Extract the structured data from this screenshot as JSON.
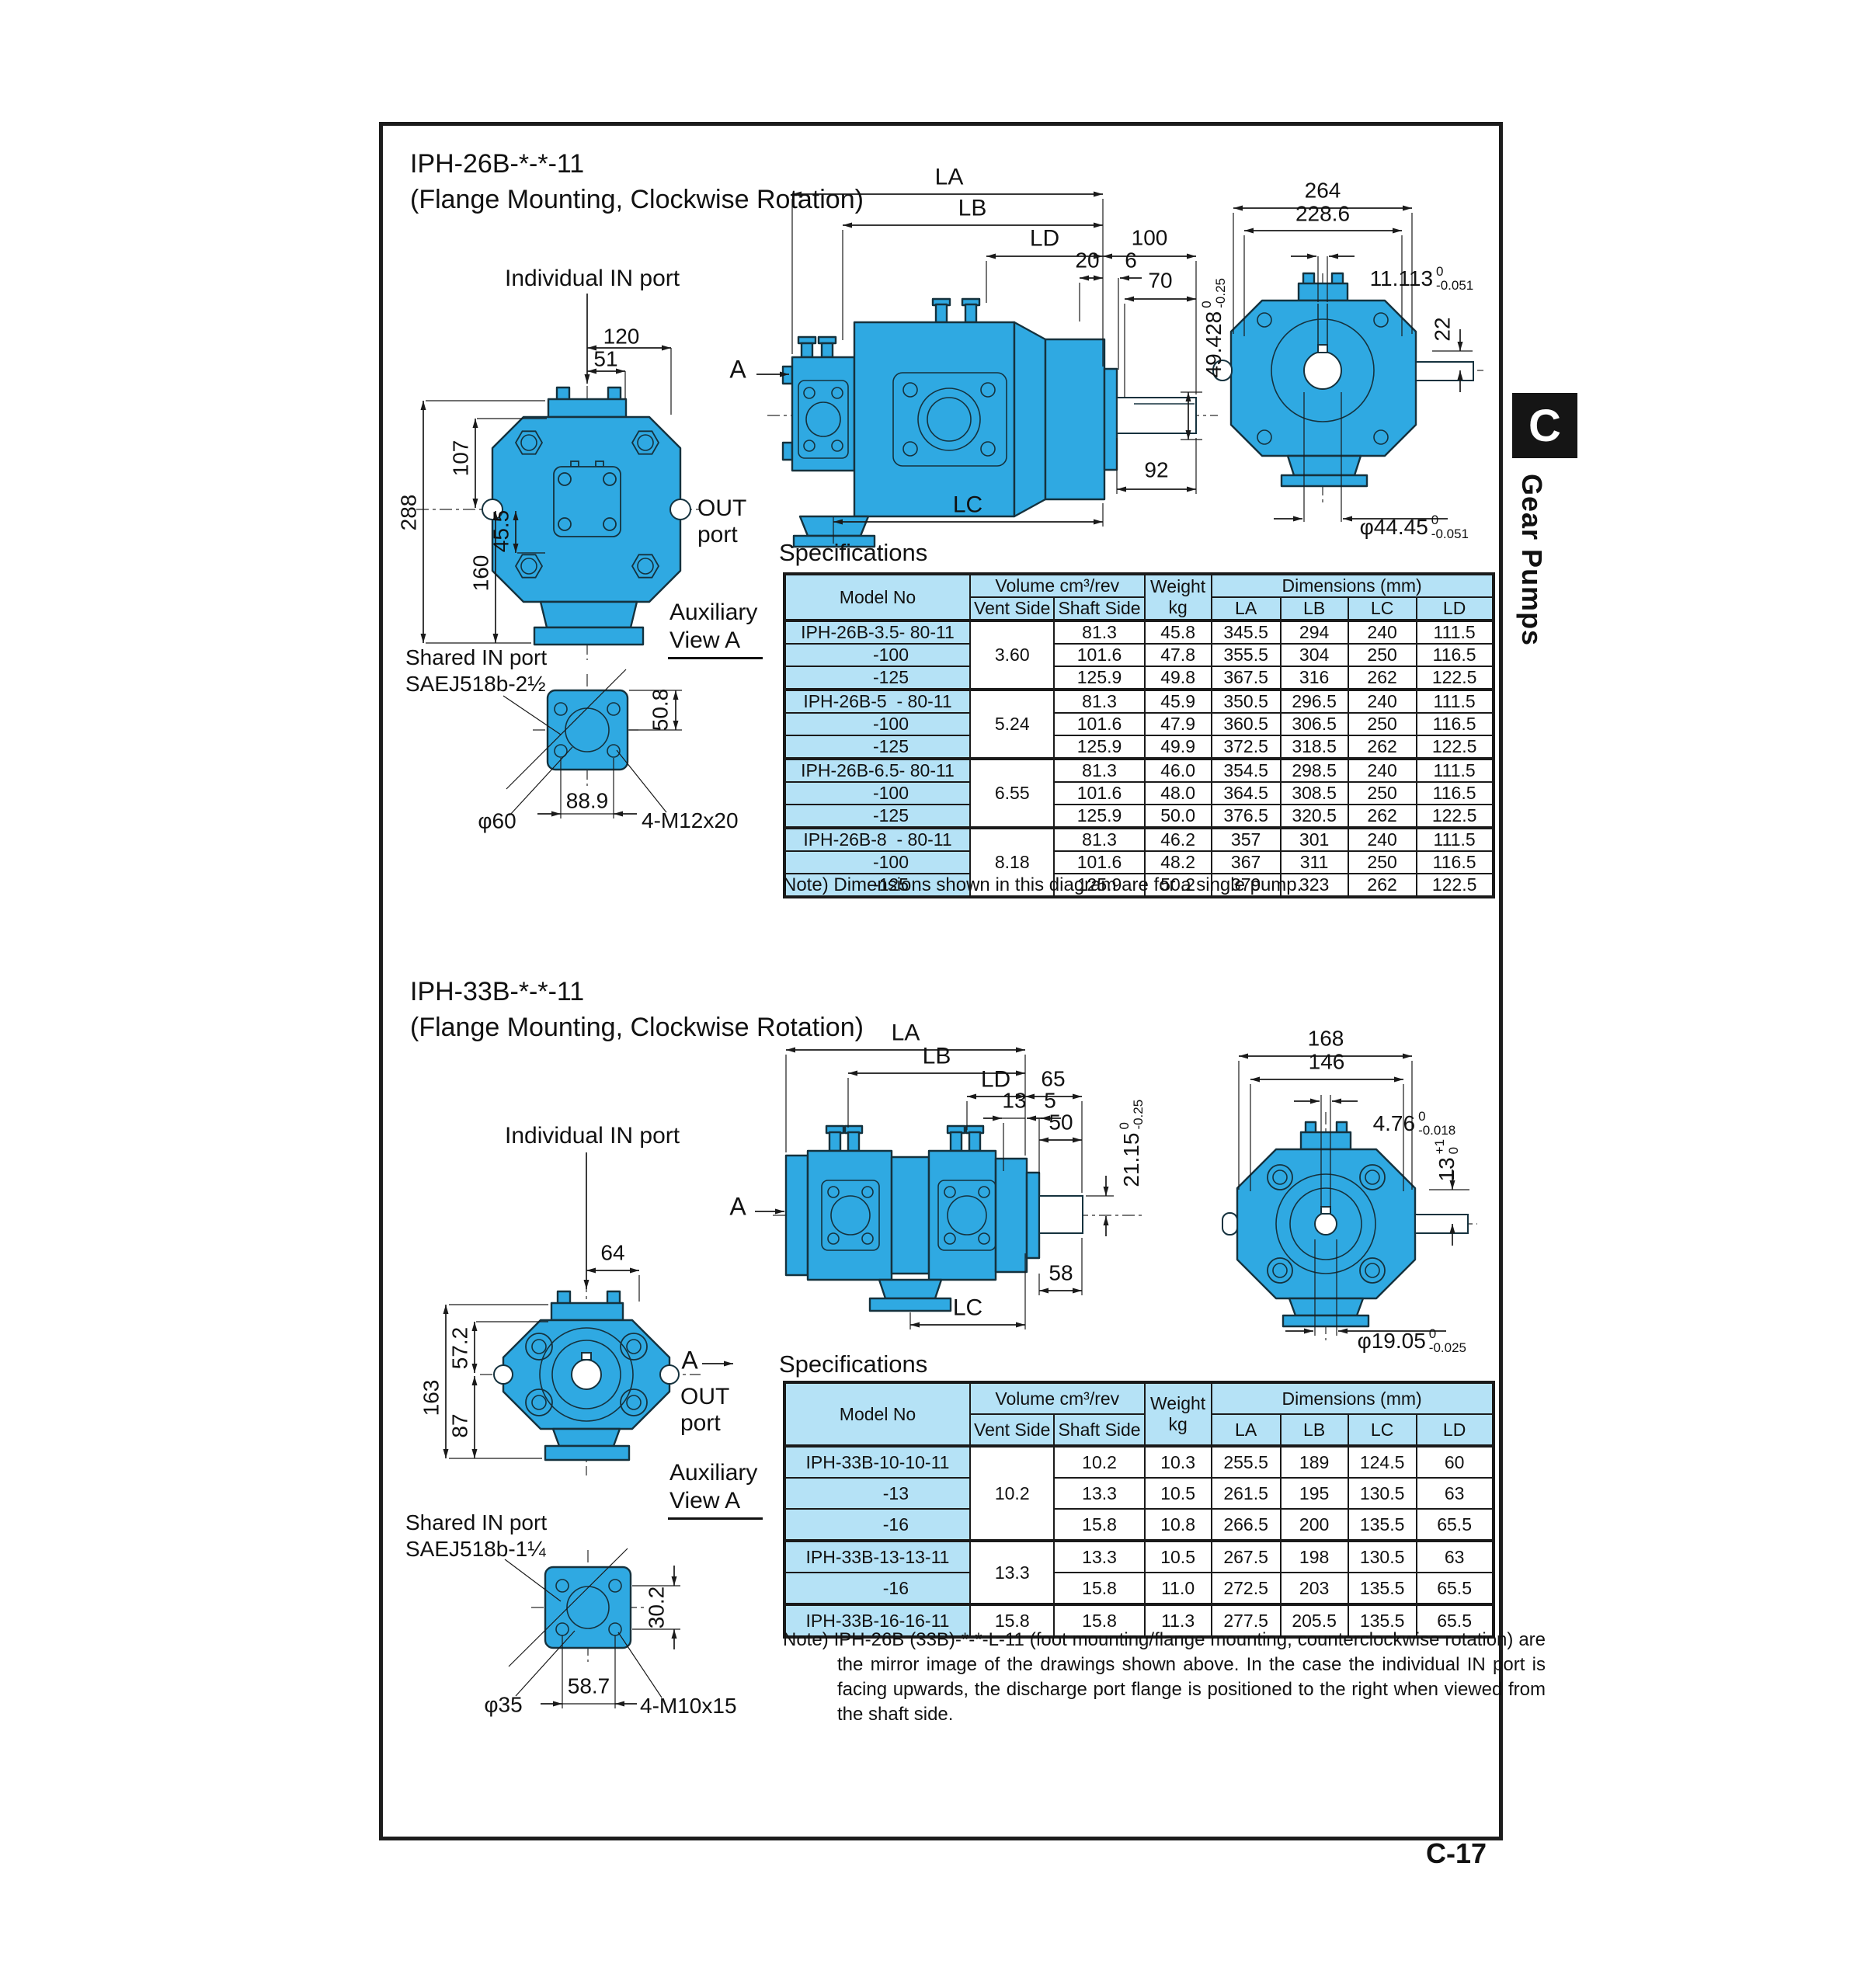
{
  "page": {
    "tab_letter": "C",
    "tab_label": "Gear Pumps",
    "page_number": "C-17"
  },
  "section1": {
    "title": "IPH-26B-*-*-11",
    "subtitle": "(Flange Mounting, Clockwise Rotation)",
    "labels": {
      "individual_in_port": "Individual IN port",
      "out_line1": "OUT",
      "out_line2": "port",
      "aux_line1": "Auxiliary",
      "aux_line2": "View A",
      "shared_in_port": "Shared IN port",
      "shared_in_spec": "SAEJ518b-2½",
      "view_arrow": "A"
    },
    "front_dims": {
      "d120": "120",
      "d51": "51",
      "d288": "288",
      "d107": "107",
      "d160": "160",
      "d45_5": "45.5"
    },
    "aux_dims": {
      "d50_8": "50.8",
      "dia": "φ60",
      "d88_9": "88.9",
      "bolts": "4-M12x20"
    },
    "side_dims": {
      "la": "LA",
      "lb": "LB",
      "ld": "LD",
      "d100": "100",
      "d20": "20",
      "d6": "6",
      "d70": "70",
      "d92": "92",
      "lc": "LC"
    },
    "side_shaft_tol": {
      "main": "49.428",
      "sup": "0",
      "sub": "-0.25"
    },
    "rear_dims": {
      "d264": "264",
      "d228_6": "228.6",
      "d22": "22"
    },
    "rear_key_tol": {
      "main": "11.113",
      "sup": "0",
      "sub": "-0.051"
    },
    "rear_shaft_dia": {
      "main": "φ44.45",
      "sup": "0",
      "sub": "-0.051"
    },
    "spec_heading": "Specifications",
    "note": "Note) Dimensions shown in this diagram are for a single pump."
  },
  "section2": {
    "title": "IPH-33B-*-*-11",
    "subtitle": "(Flange Mounting, Clockwise Rotation)",
    "labels": {
      "individual_in_port": "Individual IN port",
      "out_line1": "OUT",
      "out_line2": "port",
      "aux_line1": "Auxiliary",
      "aux_line2": "View A",
      "shared_in_port": "Shared IN port",
      "shared_in_spec": "SAEJ518b-1¼",
      "view_arrow": "A",
      "out_view_arrow": "A"
    },
    "front_dims": {
      "d64": "64",
      "d163": "163",
      "d57_2": "57.2",
      "d87": "87"
    },
    "aux_dims": {
      "d30_2": "30.2",
      "dia": "φ35",
      "d58_7": "58.7",
      "bolts": "4-M10x15"
    },
    "side_dims": {
      "la": "LA",
      "lb": "LB",
      "ld": "LD",
      "d65": "65",
      "d13": "13",
      "d5": "5",
      "d50": "50",
      "d58": "58",
      "lc": "LC"
    },
    "side_shaft_tol": {
      "main": "21.15",
      "sup": "0",
      "sub": "-0.25"
    },
    "rear_dims": {
      "d168": "168",
      "d146": "146"
    },
    "rear_key_tol": {
      "main": "4.76",
      "sup": "0",
      "sub": "-0.018"
    },
    "rear_key_height": {
      "main": "13",
      "sup": "+1",
      "sub": "0"
    },
    "rear_shaft_dia": {
      "main": "φ19.05",
      "sup": "0",
      "sub": "-0.025"
    },
    "spec_heading": "Specifications",
    "note": "Note) IPH-26B (33B)-*-*-L-11 (foot mounting/flange mounting, counterclockwise rotation) are the mirror image of the drawings shown above. In the case the individual IN port is facing upwards, the discharge port flange is positioned to the right when viewed from the shaft side."
  },
  "tables": {
    "headers": {
      "model": "Model No",
      "volume": "Volume cm³/rev",
      "vent": "Vent Side",
      "shaft": "Shaft Side",
      "weight": "Weight",
      "kg": "kg",
      "dims": "Dimensions (mm)",
      "la": "LA",
      "lb": "LB",
      "lc": "LC",
      "ld": "LD"
    },
    "spec1": {
      "groups": [
        {
          "vent": "3.60",
          "rows": [
            {
              "model": "IPH-26B-3.5- 80-11",
              "shaft": "81.3",
              "weight": "45.8",
              "la": "345.5",
              "lb": "294",
              "lc": "240",
              "ld": "111.5"
            },
            {
              "model": "-100",
              "shaft": "101.6",
              "weight": "47.8",
              "la": "355.5",
              "lb": "304",
              "lc": "250",
              "ld": "116.5"
            },
            {
              "model": "-125",
              "shaft": "125.9",
              "weight": "49.8",
              "la": "367.5",
              "lb": "316",
              "lc": "262",
              "ld": "122.5"
            }
          ]
        },
        {
          "vent": "5.24",
          "rows": [
            {
              "model": "IPH-26B-5  - 80-11",
              "shaft": "81.3",
              "weight": "45.9",
              "la": "350.5",
              "lb": "296.5",
              "lc": "240",
              "ld": "111.5"
            },
            {
              "model": "-100",
              "shaft": "101.6",
              "weight": "47.9",
              "la": "360.5",
              "lb": "306.5",
              "lc": "250",
              "ld": "116.5"
            },
            {
              "model": "-125",
              "shaft": "125.9",
              "weight": "49.9",
              "la": "372.5",
              "lb": "318.5",
              "lc": "262",
              "ld": "122.5"
            }
          ]
        },
        {
          "vent": "6.55",
          "rows": [
            {
              "model": "IPH-26B-6.5- 80-11",
              "shaft": "81.3",
              "weight": "46.0",
              "la": "354.5",
              "lb": "298.5",
              "lc": "240",
              "ld": "111.5"
            },
            {
              "model": "-100",
              "shaft": "101.6",
              "weight": "48.0",
              "la": "364.5",
              "lb": "308.5",
              "lc": "250",
              "ld": "116.5"
            },
            {
              "model": "-125",
              "shaft": "125.9",
              "weight": "50.0",
              "la": "376.5",
              "lb": "320.5",
              "lc": "262",
              "ld": "122.5"
            }
          ]
        },
        {
          "vent": "8.18",
          "rows": [
            {
              "model": "IPH-26B-8  - 80-11",
              "shaft": "81.3",
              "weight": "46.2",
              "la": "357",
              "lb": "301",
              "lc": "240",
              "ld": "111.5"
            },
            {
              "model": "-100",
              "shaft": "101.6",
              "weight": "48.2",
              "la": "367",
              "lb": "311",
              "lc": "250",
              "ld": "116.5"
            },
            {
              "model": "-125",
              "shaft": "125.9",
              "weight": "50.2",
              "la": "379",
              "lb": "323",
              "lc": "262",
              "ld": "122.5"
            }
          ]
        }
      ]
    },
    "spec2": {
      "groups": [
        {
          "vent": "10.2",
          "rows": [
            {
              "model": "IPH-33B-10-10-11",
              "shaft": "10.2",
              "weight": "10.3",
              "la": "255.5",
              "lb": "189",
              "lc": "124.5",
              "ld": "60"
            },
            {
              "model": "-13",
              "shaft": "13.3",
              "weight": "10.5",
              "la": "261.5",
              "lb": "195",
              "lc": "130.5",
              "ld": "63"
            },
            {
              "model": "-16",
              "shaft": "15.8",
              "weight": "10.8",
              "la": "266.5",
              "lb": "200",
              "lc": "135.5",
              "ld": "65.5"
            }
          ]
        },
        {
          "vent": "13.3",
          "rows": [
            {
              "model": "IPH-33B-13-13-11",
              "shaft": "13.3",
              "weight": "10.5",
              "la": "267.5",
              "lb": "198",
              "lc": "130.5",
              "ld": "63"
            },
            {
              "model": "-16",
              "shaft": "15.8",
              "weight": "11.0",
              "la": "272.5",
              "lb": "203",
              "lc": "135.5",
              "ld": "65.5"
            }
          ]
        },
        {
          "vent": "15.8",
          "rows": [
            {
              "model": "IPH-33B-16-16-11",
              "shaft": "15.8",
              "weight": "11.3",
              "la": "277.5",
              "lb": "205.5",
              "lc": "135.5",
              "ld": "65.5"
            }
          ]
        }
      ]
    }
  }
}
